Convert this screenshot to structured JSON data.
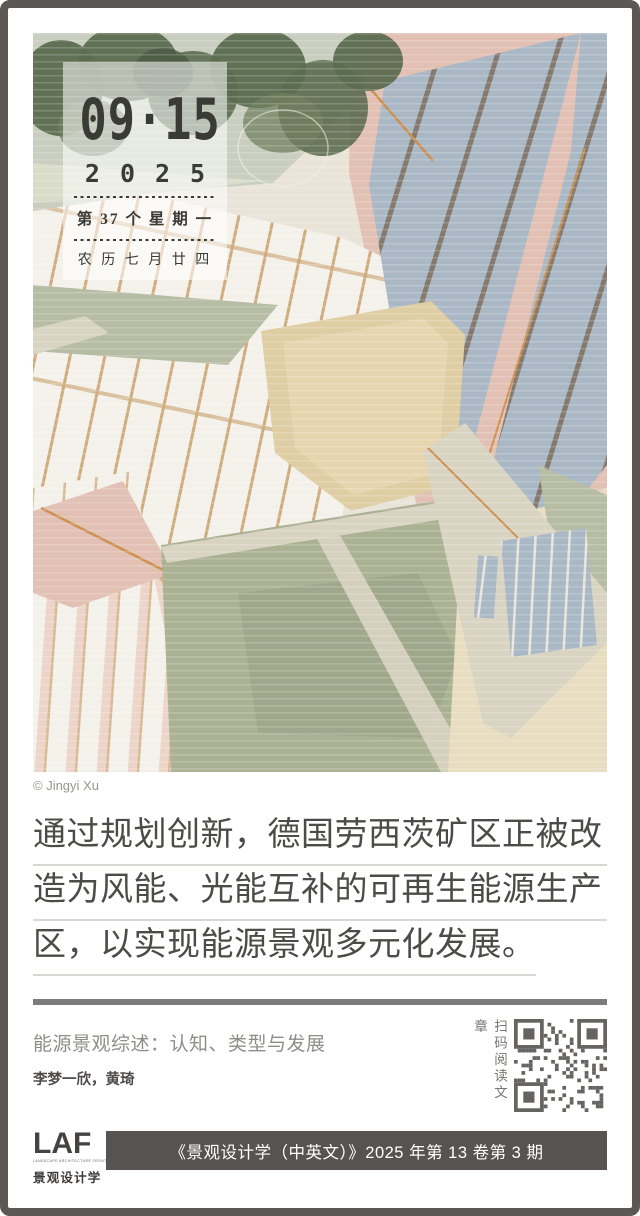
{
  "frame": {
    "border_color": "#5a5755",
    "background": "#ffffff"
  },
  "calendar": {
    "date_large": "09·15",
    "year": "2025",
    "week_line": "第 37 个 星 期 一",
    "lunar_line": "农 历 七 月 廿 四",
    "text_color": "#3b3b36"
  },
  "illustration": {
    "credit": "© Jingyi Xu",
    "palette": {
      "base": "#e9e3d8",
      "sage": "#c9cec0",
      "sage_light": "#d8dcc9",
      "vegetation": "#5c6b50",
      "vegetation_light": "#72805f",
      "vegetation_dark": "#4b5a43",
      "pink": "#e2c0b3",
      "pink_light": "#ecd4c8",
      "white_panel": "#f3f1ea",
      "panel_gap": "#cfab7e",
      "blue_panel": "#aab8c5",
      "blue_edge": "#85796e",
      "sand": "#dfcda4",
      "sand_light": "#ead9b4",
      "sand2": "#e8ddc1",
      "meadow": "#abb294",
      "meadow_dark": "#96a083",
      "meadow_band": "#b7bda4",
      "path": "#d9d4c2",
      "orange": "#cd9050",
      "sketch": "#f0f2e6",
      "qr": "#666460"
    }
  },
  "quote": {
    "lines": [
      "通过规划创新，德国劳西茨矿区正被改",
      "造为风能、光能互补的可再生能源生产",
      "区，以实现能源景观多元化发展。"
    ],
    "divider_color": "#7c7c7c"
  },
  "article": {
    "title": "能源景观综述：认知、类型与发展",
    "authors": "李梦一欣，黄琦",
    "qr_caption": "扫码阅读文章"
  },
  "footer": {
    "logo_main": "LAF",
    "logo_sub": "LANDSCAPE ARCHITECTURE FRONTIERS",
    "logo_cn": "景观设计学",
    "issue_text": "《景观设计学（中英文）》2025 年第 13 卷第 3 期",
    "bar_color": "#575350"
  }
}
